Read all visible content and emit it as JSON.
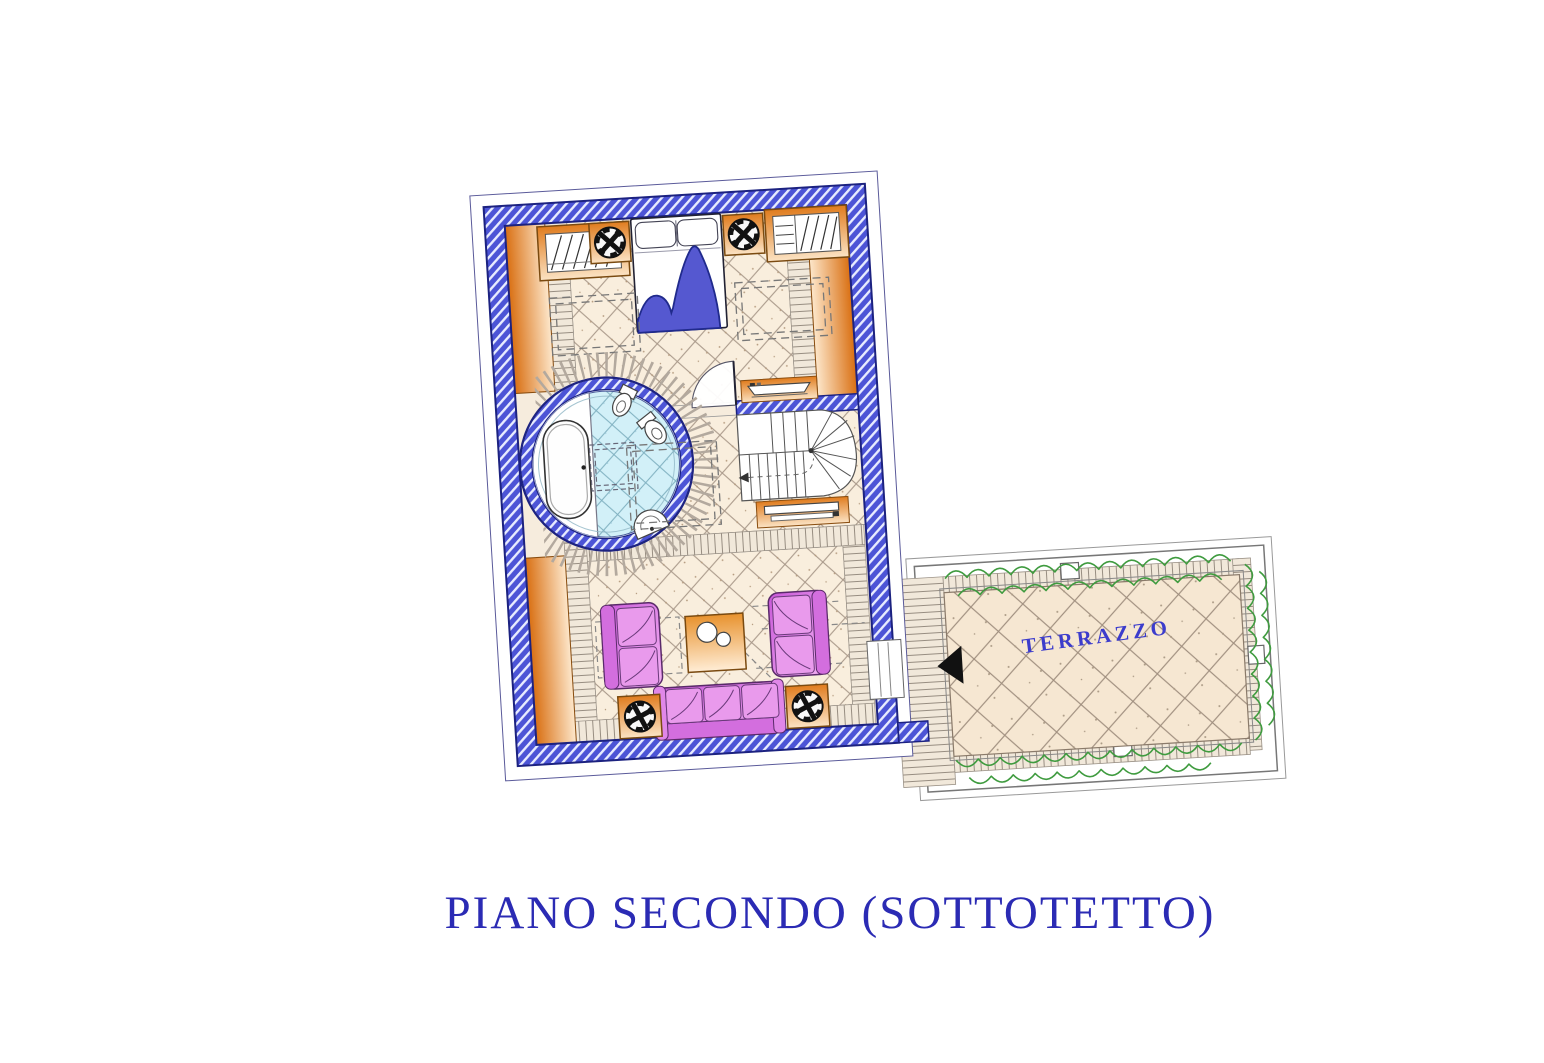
{
  "page": {
    "title": "PIANO SECONDO (SOTTOTETTO)"
  },
  "labels": {
    "terrace": "TERRAZZO"
  },
  "palette": {
    "title_blue": "#2b2bb4",
    "label_blue": "#3c3ccc",
    "wall_blue": "#4c54d6",
    "wall_hatch_light": "#e8ecff",
    "wall_outline": "#1c2280",
    "floor_cream": "#f9eedd",
    "tile_line": "#a9998a",
    "bath_cyan": "#d2f0f8",
    "bath_tile_line": "#7fb0c0",
    "terrace_cream": "#f6e7d2",
    "furniture_orange_dark": "#d96f12",
    "furniture_orange_light": "#fde7cb",
    "sofa_purple_dark": "#c858d8",
    "sofa_purple_light": "#f4b2f4",
    "blanket_blue": "#5558d0",
    "hedge_green": "#3f9b3f",
    "arrow_black": "#111111"
  }
}
